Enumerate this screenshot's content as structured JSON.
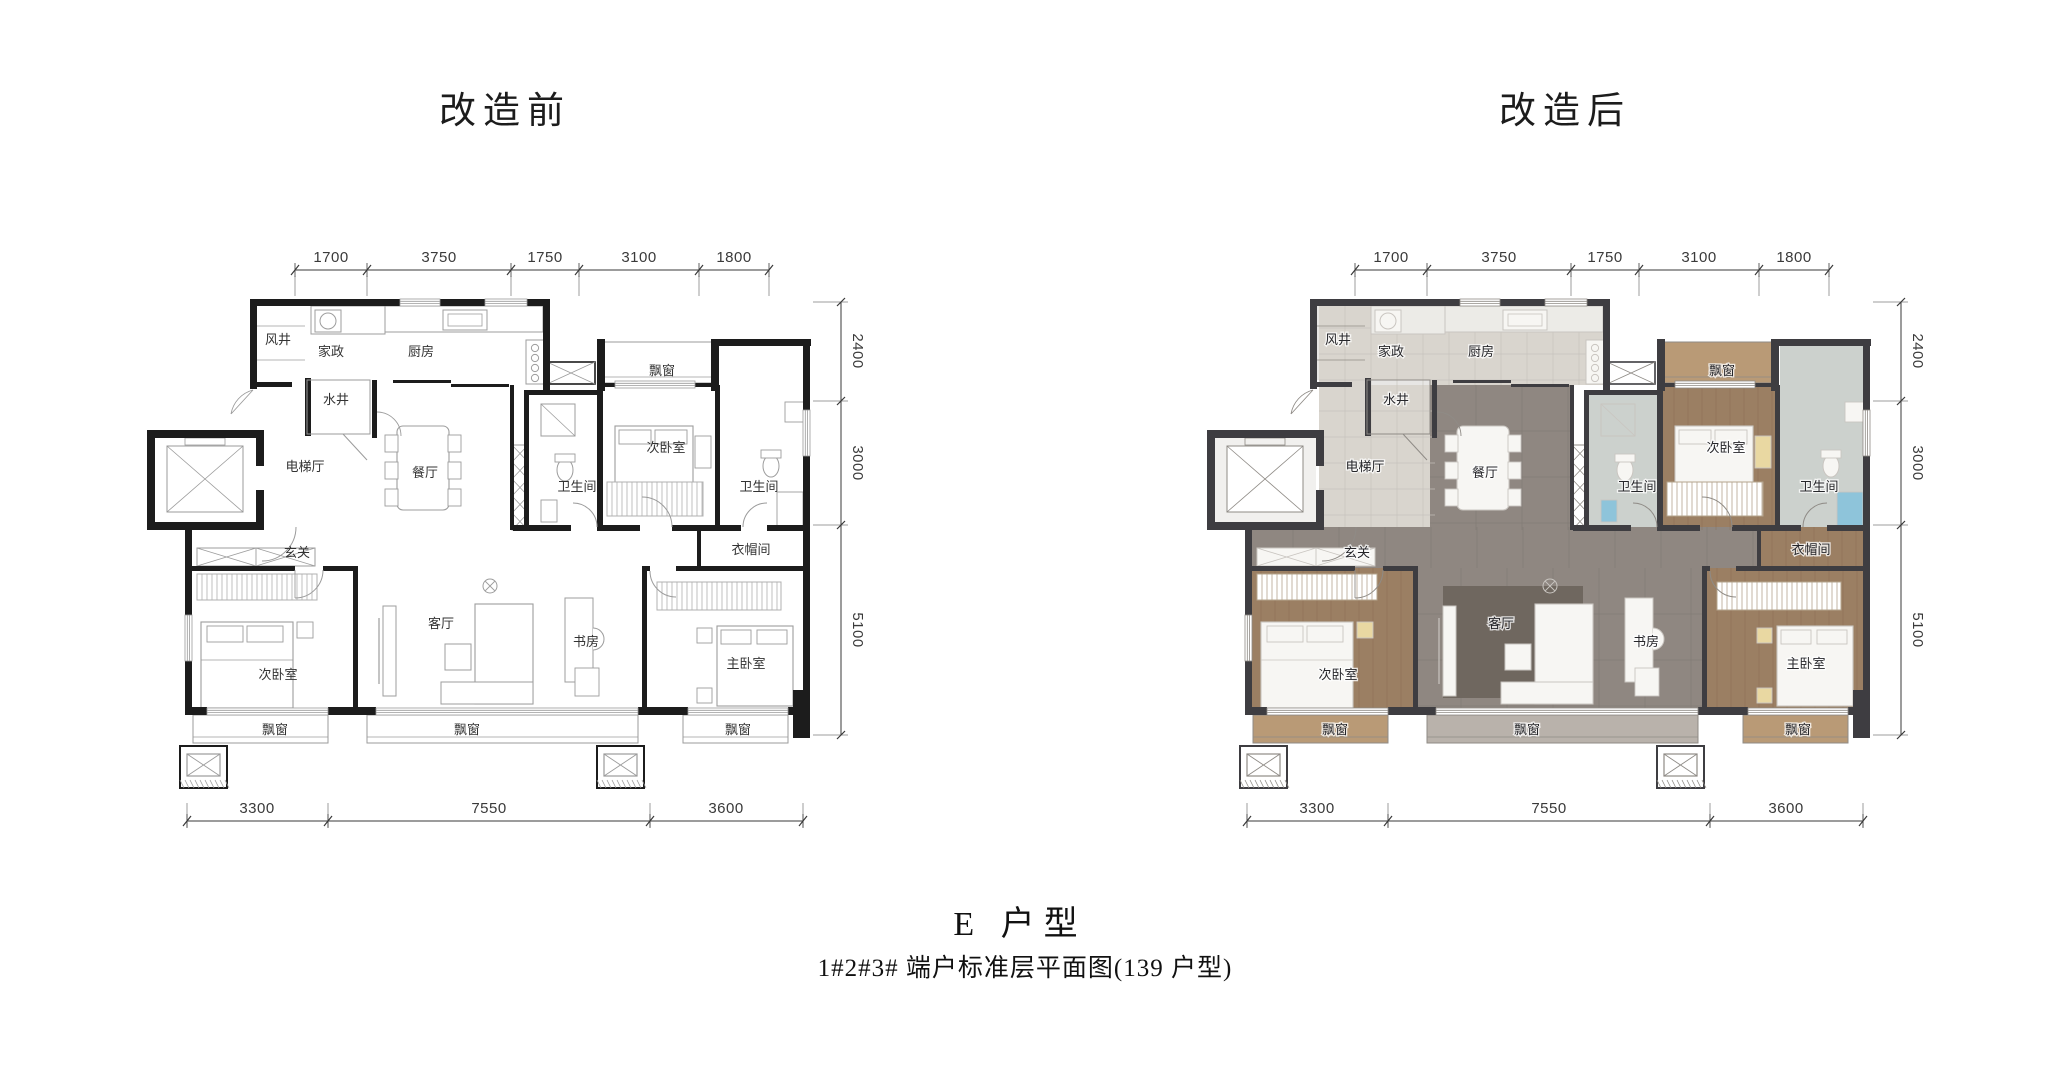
{
  "titles": {
    "before": "改造前",
    "after": "改造后"
  },
  "captions": {
    "unit_type": "E 户型",
    "subtitle": "1#2#3# 端户标准层平面图(139 户型)"
  },
  "dims": {
    "top": [
      "1700",
      "3750",
      "1750",
      "3100",
      "1800"
    ],
    "right": [
      "2400",
      "3000",
      "5100"
    ],
    "bottom": [
      "3300",
      "7550",
      "3600"
    ]
  },
  "rooms": {
    "wind_shaft": "风井",
    "housekeeping": "家政",
    "kitchen": "厨房",
    "water_shaft": "水井",
    "elevator_hall": "电梯厅",
    "dining": "餐厅",
    "foyer": "玄关",
    "bath_1": "卫生间",
    "bedroom_2": "次卧室",
    "bay_tr": "飘窗",
    "bath_2": "卫生间",
    "cloakroom": "衣帽间",
    "study": "书房",
    "master": "主卧室",
    "living": "客厅",
    "bedroom_1": "次卧室",
    "bay_bl": "飘窗",
    "bay_bc": "飘窗",
    "bay_br": "飘窗"
  },
  "colors": {
    "wall_before": "#1c1c1c",
    "wall_after": "#3e3d41",
    "line": "#9b9b9b",
    "furniture_fill": "#f7f6f3",
    "tile_light": "#d9d5ce",
    "shaft": "#e7e6e4",
    "marble_gray": "#8f8781",
    "marble_line": "#7b746e",
    "wood": "#9b7f63",
    "wood_line": "#85684e",
    "wood_light": "#b99a76",
    "bath_tile": "#ccd1cd",
    "rug": "#6f675f",
    "accent_blue": "#8ec4da",
    "accent_yellow": "#e9d8a2",
    "bay_gray": "#b9b2ab",
    "elevator_floor": "#f1f0ee",
    "dim_text": "#3a3a3a"
  }
}
